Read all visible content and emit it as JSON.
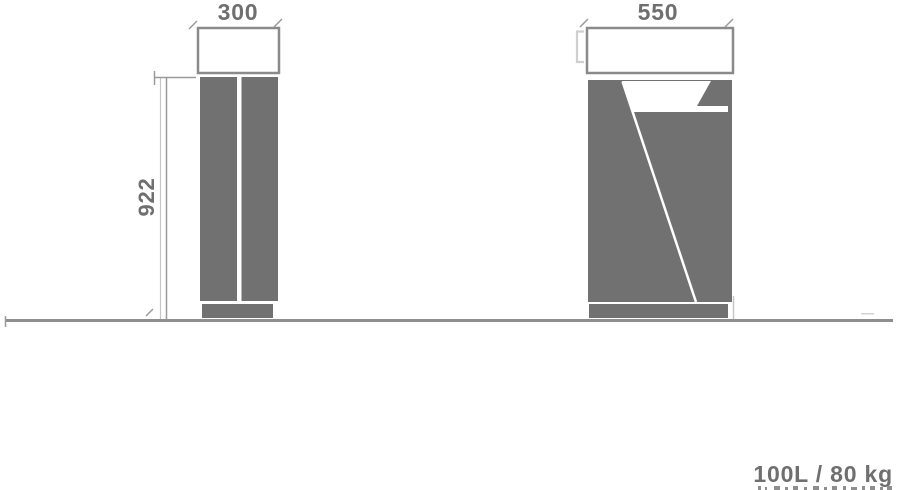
{
  "canvas": {
    "width": 898,
    "height": 490,
    "background": "#ffffff"
  },
  "palette": {
    "body_fill": "#717171",
    "outline_stroke": "#8a8a8a",
    "dim_line": "#9a9a9a",
    "light_line": "#c6c6c6",
    "ground_line": "#8e8e8e",
    "label_text": "#6f6f6f",
    "cutout_white": "#ffffff"
  },
  "diagram": {
    "kind": "product dimension drawing",
    "subject": "litter bin elevations (side view and front view) on a ground line",
    "views": {
      "side_elevation": {
        "description": "left view: lid outline on top of two vertical body panels with base plate",
        "depth_label": "300",
        "height_label": "922"
      },
      "front_elevation": {
        "description": "right view: lid outline, body with angled white opening, hood flap and diagonal seam, base plate",
        "width_label": "550"
      }
    },
    "labels": {
      "depth": "300",
      "width": "550",
      "height": "922"
    },
    "footer": {
      "capacity_weight": "100L / 80 kg"
    }
  }
}
